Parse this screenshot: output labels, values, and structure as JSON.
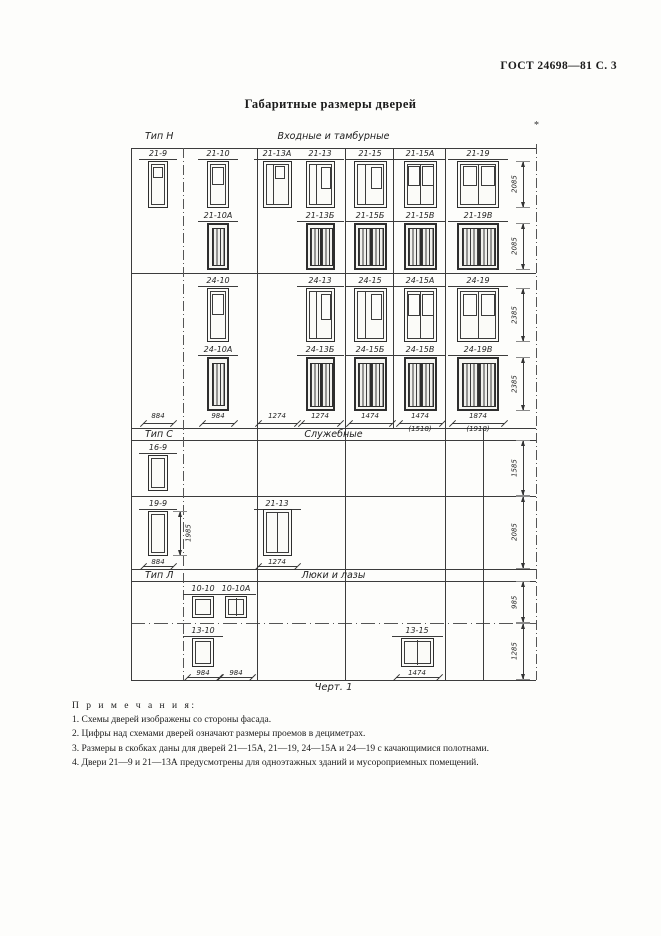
{
  "page": {
    "header": "ГОСТ 24698—81 С. 3",
    "title": "Габаритные размеры дверей",
    "caption": "Черт. 1",
    "footnote_mark": "*"
  },
  "sections": [
    {
      "id": "N",
      "type_label": "Тип Н",
      "group_label": "Входные и тамбурные",
      "rows": [
        {
          "right_dim": "2085",
          "doors": [
            {
              "label": "21-9",
              "col": 0,
              "w": 884,
              "h": 2085,
              "glyph": "single-small-window"
            },
            {
              "label": "21-10",
              "col": 1,
              "w": 984,
              "h": 2085,
              "glyph": "single-window"
            },
            {
              "label": "21-13А",
              "col": 2,
              "w": 1274,
              "h": 2085,
              "glyph": "leaf-and-half-small"
            },
            {
              "label": "21-13",
              "col": 3,
              "w": 1274,
              "h": 2085,
              "glyph": "leaf-and-half"
            },
            {
              "label": "21-15",
              "col": 4,
              "w": 1474,
              "h": 2085,
              "glyph": "leaf-and-half"
            },
            {
              "label": "21-15А",
              "col": 5,
              "w": 1474,
              "h": 2085,
              "glyph": "double-window"
            },
            {
              "label": "21-19",
              "col": 6,
              "w": 1874,
              "h": 2085,
              "glyph": "double-window"
            }
          ]
        },
        {
          "right_dim": "2085",
          "doors": [
            {
              "label": "21-10А",
              "col": 1,
              "w": 984,
              "h": 2085,
              "glyph": "louver-single"
            },
            {
              "label": "21-13Б",
              "col": 3,
              "w": 1274,
              "h": 2085,
              "glyph": "louver-double"
            },
            {
              "label": "21-15Б",
              "col": 4,
              "w": 1474,
              "h": 2085,
              "glyph": "louver-double"
            },
            {
              "label": "21-15В",
              "col": 5,
              "w": 1474,
              "h": 2085,
              "glyph": "louver-double"
            },
            {
              "label": "21-19В",
              "col": 6,
              "w": 1874,
              "h": 2085,
              "glyph": "louver-double"
            }
          ]
        },
        {
          "right_dim": "2385",
          "doors": [
            {
              "label": "24-10",
              "col": 1,
              "w": 984,
              "h": 2385,
              "glyph": "single-window"
            },
            {
              "label": "24-13",
              "col": 3,
              "w": 1274,
              "h": 2385,
              "glyph": "leaf-and-half"
            },
            {
              "label": "24-15",
              "col": 4,
              "w": 1474,
              "h": 2385,
              "glyph": "leaf-and-half"
            },
            {
              "label": "24-15А",
              "col": 5,
              "w": 1474,
              "h": 2385,
              "glyph": "double-window"
            },
            {
              "label": "24-19",
              "col": 6,
              "w": 1874,
              "h": 2385,
              "glyph": "double-window"
            }
          ]
        },
        {
          "right_dim": "2385",
          "doors": [
            {
              "label": "24-10А",
              "col": 1,
              "w": 984,
              "h": 2385,
              "glyph": "louver-single"
            },
            {
              "label": "24-13Б",
              "col": 3,
              "w": 1274,
              "h": 2385,
              "glyph": "louver-double"
            },
            {
              "label": "24-15Б",
              "col": 4,
              "w": 1474,
              "h": 2385,
              "glyph": "louver-double"
            },
            {
              "label": "24-15В",
              "col": 5,
              "w": 1474,
              "h": 2385,
              "glyph": "louver-double"
            },
            {
              "label": "24-19В",
              "col": 6,
              "w": 1874,
              "h": 2385,
              "glyph": "louver-double"
            }
          ]
        }
      ],
      "bottom_dims": [
        {
          "col": 0,
          "w": 884,
          "text": "884"
        },
        {
          "col": 1,
          "w": 984,
          "text": "984"
        },
        {
          "col": 2,
          "w": 1274,
          "text": "1274"
        },
        {
          "col": 3,
          "w": 1274,
          "text": "1274"
        },
        {
          "col": 4,
          "w": 1474,
          "text": "1474"
        },
        {
          "col": 5,
          "w": 1474,
          "text": "1474",
          "paren": "(1518)"
        },
        {
          "col": 6,
          "w": 1874,
          "text": "1874",
          "paren": "(1918)"
        }
      ]
    },
    {
      "id": "C",
      "type_label": "Тип С",
      "group_label": "Служебные",
      "rows": [
        {
          "right_dim": "1585",
          "doors": [
            {
              "label": "16-9",
              "col": 0,
              "w": 884,
              "h": 1585,
              "glyph": "plain-single"
            }
          ]
        },
        {
          "right_dim": "2085",
          "doors": [
            {
              "label": "19-9",
              "col": 0,
              "w": 884,
              "h": 1985,
              "glyph": "plain-single",
              "side_dim": "1985",
              "bottom_dim": "884"
            },
            {
              "label": "21-13",
              "col": 2,
              "w": 1274,
              "h": 2085,
              "glyph": "plain-double",
              "bottom_dim": "1274"
            }
          ]
        }
      ]
    },
    {
      "id": "L",
      "type_label": "Тип Л",
      "group_label": "Люки и лазы",
      "rows": [
        {
          "right_dim": "985",
          "doors": [
            {
              "label": "10-10",
              "cx": 72,
              "w": 984,
              "h": 985,
              "glyph": "plain-single"
            },
            {
              "label": "10-10А",
              "cx": 105,
              "w": 984,
              "h": 985,
              "glyph": "plain-double"
            }
          ]
        },
        {
          "right_dim": "1285",
          "doors": [
            {
              "label": "13-10",
              "cx": 72,
              "w": 984,
              "h": 1285,
              "glyph": "plain-single",
              "bottom_dim": "984"
            },
            {
              "label": "13-15",
              "cx": 286,
              "w": 1474,
              "h": 1285,
              "glyph": "plain-double",
              "bottom_dim": "1474"
            }
          ],
          "extra_dims": [
            {
              "cx": 105,
              "w": 984,
              "text": "984"
            }
          ]
        }
      ]
    }
  ],
  "notes": {
    "heading": "П р и м е ч а н и я:",
    "items": [
      "1. Схемы дверей изображены со стороны фасада.",
      "2. Цифры над схемами дверей означают размеры проемов в дециметрах.",
      "3. Размеры в скобках даны для дверей 21—15А, 21—19, 24—15А и 24—19 с качающимися полотнами.",
      "4. Двери 21—9 и 21—13А предусмотрены для одноэтажных зданий и мусороприемных помещений."
    ]
  },
  "colors": {
    "line": "#3c3c3c",
    "text": "#1b1b1b",
    "paper": "#fdfdfb"
  }
}
